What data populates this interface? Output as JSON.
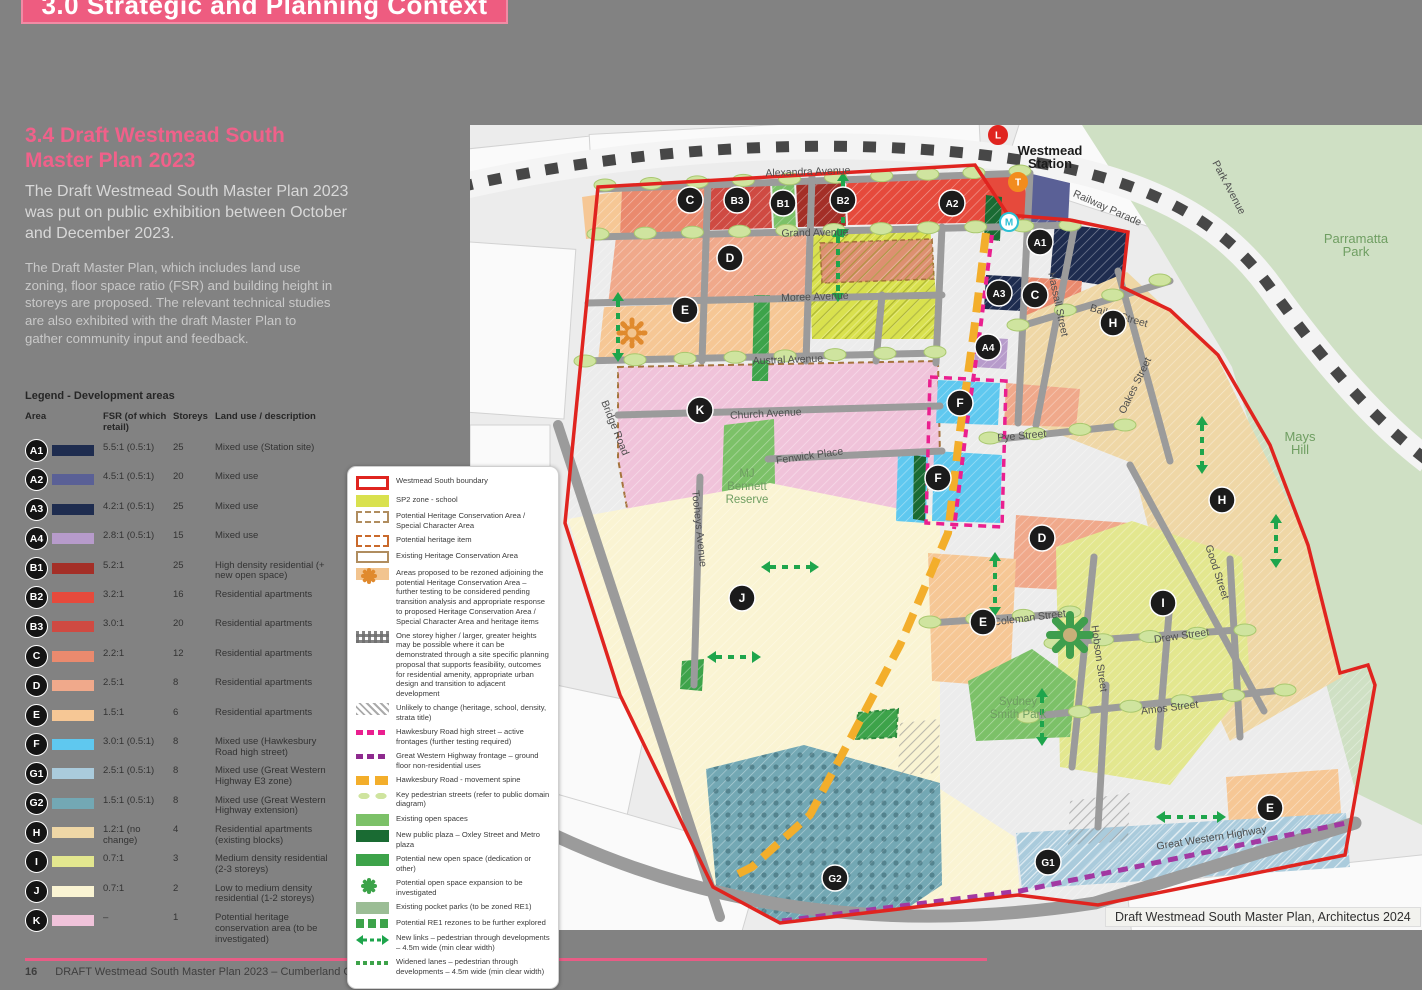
{
  "page": {
    "banner_title": "3.0 Strategic and Planning Context",
    "section_heading": "3.4 Draft Westmead South Master Plan 2023",
    "para1": "The Draft Westmead South Master Plan 2023 was put on public exhibition between October and December 2023.",
    "para2": "The Draft Master Plan, which includes land use zoning, floor space ratio (FSR) and building height in storeys are proposed. The relevant technical studies are also exhibited with the draft Master Plan to gather community input and feedback.",
    "footer_page": "16",
    "footer_text": "DRAFT Westmead South Master Plan 2023 – Cumberland City Council"
  },
  "palette": {
    "A1": "#1e2c4f",
    "A2": "#5a6096",
    "A3": "#1e2c4f",
    "A4": "#b79bcb",
    "B1": "#a42f27",
    "B2": "#e64a3c",
    "B3": "#cf4a42",
    "C": "#ea8a6e",
    "D": "#f0a98b",
    "Ddark": "#dd9070",
    "E": "#f6c795",
    "F": "#5fc8ef",
    "G1": "#aacbdc",
    "G2": "#73a8b4",
    "H": "#efd7a6",
    "I": "#e3e78f",
    "J": "#faf4d3",
    "K": "#f0c3da",
    "school": "#d9e14e",
    "open": "#7cc168",
    "newopen": "#3da34a",
    "plaza": "#1a6b33",
    "sage": "#9bbd95",
    "road": "#9b9b9b",
    "boundary": "#e0241f",
    "spine": "#f3ae2b",
    "magenta": "#ea1f8f",
    "purple": "#a238a2",
    "parkland": "#cfe0c4",
    "accent_pink": "#ee5c80"
  },
  "dev_legend": {
    "title": "Legend - Development areas",
    "columns": {
      "area": "Area",
      "fsr": "FSR (of which retail)",
      "storeys": "Storeys",
      "use": "Land use / description"
    },
    "rows": [
      {
        "area": "A1",
        "fsr": "5.5:1 (0.5:1)",
        "storeys": "25",
        "use": "Mixed use (Station site)"
      },
      {
        "area": "A2",
        "fsr": "4.5:1 (0.5:1)",
        "storeys": "20",
        "use": "Mixed use"
      },
      {
        "area": "A3",
        "fsr": "4.2:1 (0.5:1)",
        "storeys": "25",
        "use": "Mixed use"
      },
      {
        "area": "A4",
        "fsr": "2.8:1 (0.5:1)",
        "storeys": "15",
        "use": "Mixed use"
      },
      {
        "area": "B1",
        "fsr": "5.2:1",
        "storeys": "25",
        "use": "High density residential (+ new open space)"
      },
      {
        "area": "B2",
        "fsr": "3.2:1",
        "storeys": "16",
        "use": "Residential apartments"
      },
      {
        "area": "B3",
        "fsr": "3.0:1",
        "storeys": "20",
        "use": "Residential apartments"
      },
      {
        "area": "C",
        "fsr": "2.2:1",
        "storeys": "12",
        "use": "Residential apartments"
      },
      {
        "area": "D",
        "fsr": "2.5:1",
        "storeys": "8",
        "use": "Residential apartments"
      },
      {
        "area": "E",
        "fsr": "1.5:1",
        "storeys": "6",
        "use": "Residential apartments"
      },
      {
        "area": "F",
        "fsr": "3.0:1 (0.5:1)",
        "storeys": "8",
        "use": "Mixed use (Hawkesbury Road high street)"
      },
      {
        "area": "G1",
        "fsr": "2.5:1 (0.5:1)",
        "storeys": "8",
        "use": "Mixed use (Great Western Highway E3 zone)"
      },
      {
        "area": "G2",
        "fsr": "1.5:1 (0.5:1)",
        "storeys": "8",
        "use": "Mixed use (Great Western Highway extension)"
      },
      {
        "area": "H",
        "fsr": "1.2:1 (no change)",
        "storeys": "4",
        "use": "Residential apartments (existing blocks)"
      },
      {
        "area": "I",
        "fsr": "0.7:1",
        "storeys": "3",
        "use": "Medium density residential (2-3 storeys)"
      },
      {
        "area": "J",
        "fsr": "0.7:1",
        "storeys": "2",
        "use": "Low to medium density residential (1-2 storeys)"
      },
      {
        "area": "K",
        "fsr": "–",
        "storeys": "1",
        "use": "Potential heritage conservation area (to be investigated)"
      }
    ]
  },
  "map_legend": {
    "items": [
      {
        "sw": "boundary",
        "label": "Westmead South boundary"
      },
      {
        "sw": "school",
        "label": "SP2 zone - school"
      },
      {
        "sw": "hca",
        "label": "Potential Heritage Conservation Area / Special Character Area"
      },
      {
        "sw": "heritage-item",
        "label": "Potential heritage item"
      },
      {
        "sw": "ehca",
        "label": "Existing Heritage Conservation Area"
      },
      {
        "sw": "tanflower",
        "label": "Areas proposed to be rezoned adjoining the potential Heritage Conservation Area – further testing to be considered pending transition analysis and appropriate response to proposed Heritage Conservation Area / Special Character Area and heritage items"
      },
      {
        "sw": "check",
        "label": "One storey higher / larger, greater heights may be possible where it can be demonstrated through a site specific planning proposal that supports feasibility, outcomes for residential amenity, appropriate urban design and transition to adjacent development"
      },
      {
        "sw": "grayhatch",
        "label": "Unlikely to change (heritage, school, density, strata title)"
      },
      {
        "sw": "magenta",
        "label": "Hawkesbury Road high street – active frontages (further testing required)"
      },
      {
        "sw": "purple",
        "label": "Great Western Highway frontage – ground floor non-residential uses"
      },
      {
        "sw": "gold",
        "label": "Hawkesbury Road - movement spine"
      },
      {
        "sw": "ovals",
        "label": "Key pedestrian streets (refer to public domain diagram)"
      },
      {
        "sw": "open",
        "label": "Existing open spaces"
      },
      {
        "sw": "plaza",
        "label": "New public plaza – Oxley Street and Metro plaza"
      },
      {
        "sw": "newopen",
        "label": "Potential new open space (dedication or other)"
      },
      {
        "sw": "flower",
        "label": "Potential open space expansion to be investigated"
      },
      {
        "sw": "sage",
        "label": "Existing pocket parks (to be zoned RE1)"
      },
      {
        "sw": "re1",
        "label": "Potential RE1 rezones to be further explored"
      },
      {
        "sw": "links",
        "label": "New links – pedestrian through developments – 4.5m wide (min clear width)"
      },
      {
        "sw": "widened",
        "label": "Widened lanes – pedestrian through developments – 4.5m wide (min clear width)"
      }
    ]
  },
  "map": {
    "attribution": "Draft Westmead South Master Plan, Architectus 2024",
    "labels": [
      {
        "t": "Alexandra Avenue",
        "x": 338,
        "y": 50,
        "r": -2,
        "cls": "street"
      },
      {
        "t": "Grand Avenue",
        "x": 345,
        "y": 111,
        "r": -1,
        "cls": "street"
      },
      {
        "t": "Moree Avenue",
        "x": 345,
        "y": 175,
        "r": -2,
        "cls": "street"
      },
      {
        "t": "Austral Avenue",
        "x": 318,
        "y": 238,
        "r": -2,
        "cls": "street"
      },
      {
        "t": "Church Avenue",
        "x": 296,
        "y": 292,
        "r": -3,
        "cls": "street"
      },
      {
        "t": "Fenwick Place",
        "x": 340,
        "y": 334,
        "r": -8,
        "cls": "street"
      },
      {
        "t": "Railway Parade",
        "x": 636,
        "y": 86,
        "r": 24,
        "cls": "street"
      },
      {
        "t": "Park Avenue",
        "x": 756,
        "y": 64,
        "r": 62,
        "cls": "street"
      },
      {
        "t": "Hassall Street",
        "x": 585,
        "y": 180,
        "r": 78,
        "cls": "street"
      },
      {
        "t": "Bailey Street",
        "x": 648,
        "y": 194,
        "r": 16,
        "cls": "street"
      },
      {
        "t": "Pye Street",
        "x": 552,
        "y": 314,
        "r": -5,
        "cls": "street"
      },
      {
        "t": "Oakes Street",
        "x": 668,
        "y": 262,
        "r": -64,
        "cls": "street"
      },
      {
        "t": "Good Street",
        "x": 744,
        "y": 448,
        "r": 72,
        "cls": "street"
      },
      {
        "t": "Coleman Street",
        "x": 560,
        "y": 496,
        "r": -7,
        "cls": "street"
      },
      {
        "t": "Drew Street",
        "x": 712,
        "y": 514,
        "r": -8,
        "cls": "street"
      },
      {
        "t": "Hobson Street",
        "x": 626,
        "y": 534,
        "r": 82,
        "cls": "street"
      },
      {
        "t": "Amos Street",
        "x": 700,
        "y": 586,
        "r": -7,
        "cls": "street"
      },
      {
        "t": "Great Western Highway",
        "x": 742,
        "y": 716,
        "r": -9,
        "cls": "street"
      },
      {
        "t": "Bridge Road",
        "x": 142,
        "y": 304,
        "r": 68,
        "cls": "street"
      },
      {
        "t": "Tooheys Avenue",
        "x": 226,
        "y": 404,
        "r": 84,
        "cls": "street"
      },
      {
        "lines": [
          "MJ",
          "Bennett",
          "Reserve"
        ],
        "x": 277,
        "y": 352,
        "cls": "park"
      },
      {
        "lines": [
          "Sydney",
          "Smith Park"
        ],
        "x": 548,
        "y": 580,
        "cls": "park"
      },
      {
        "lines": [
          "Mays",
          "Hill"
        ],
        "x": 830,
        "y": 316,
        "cls": "bigpark"
      },
      {
        "lines": [
          "Parramatta",
          "Park"
        ],
        "x": 886,
        "y": 118,
        "cls": "bigpark"
      },
      {
        "lines": [
          "Westmead",
          "Station"
        ],
        "x": 580,
        "y": 30,
        "cls": "station"
      }
    ],
    "markers": [
      {
        "t": "C",
        "x": 220,
        "y": 75
      },
      {
        "t": "B3",
        "x": 267,
        "y": 75
      },
      {
        "t": "B1",
        "x": 313,
        "y": 78
      },
      {
        "t": "B2",
        "x": 373,
        "y": 75
      },
      {
        "t": "A2",
        "x": 482,
        "y": 78
      },
      {
        "t": "A1",
        "x": 570,
        "y": 117
      },
      {
        "t": "A3",
        "x": 529,
        "y": 168
      },
      {
        "t": "C",
        "x": 565,
        "y": 170
      },
      {
        "t": "H",
        "x": 643,
        "y": 198
      },
      {
        "t": "A4",
        "x": 518,
        "y": 222
      },
      {
        "t": "E",
        "x": 215,
        "y": 185
      },
      {
        "t": "D",
        "x": 260,
        "y": 133
      },
      {
        "t": "F",
        "x": 490,
        "y": 278
      },
      {
        "t": "K",
        "x": 230,
        "y": 285
      },
      {
        "t": "F",
        "x": 468,
        "y": 353
      },
      {
        "t": "D",
        "x": 572,
        "y": 413
      },
      {
        "t": "H",
        "x": 752,
        "y": 375
      },
      {
        "t": "I",
        "x": 693,
        "y": 478
      },
      {
        "t": "J",
        "x": 272,
        "y": 473
      },
      {
        "t": "E",
        "x": 513,
        "y": 497
      },
      {
        "t": "E",
        "x": 800,
        "y": 683
      },
      {
        "t": "G2",
        "x": 365,
        "y": 753
      },
      {
        "t": "G1",
        "x": 578,
        "y": 737
      }
    ],
    "transit": [
      {
        "t": "L",
        "x": 528,
        "y": 10,
        "c": "#e0241f",
        "fg": "#fff"
      },
      {
        "t": "T",
        "x": 548,
        "y": 57,
        "c": "#f28c1e",
        "fg": "#fff"
      },
      {
        "t": "M",
        "x": 539,
        "y": 97,
        "c": "#ffffff",
        "fg": "#2bbfd4",
        "ring": "#2bbfd4"
      }
    ],
    "oval_rows": [
      {
        "x1": 135,
        "y1": 60,
        "x2": 550,
        "y2": 46,
        "n": 10
      },
      {
        "x1": 128,
        "y1": 109,
        "x2": 600,
        "y2": 100,
        "n": 11
      },
      {
        "x1": 115,
        "y1": 236,
        "x2": 465,
        "y2": 227,
        "n": 8
      },
      {
        "x1": 520,
        "y1": 313,
        "x2": 655,
        "y2": 300,
        "n": 4
      },
      {
        "x1": 460,
        "y1": 497,
        "x2": 600,
        "y2": 487,
        "n": 4
      },
      {
        "x1": 585,
        "y1": 518,
        "x2": 775,
        "y2": 505,
        "n": 5
      },
      {
        "x1": 558,
        "y1": 592,
        "x2": 815,
        "y2": 565,
        "n": 6
      },
      {
        "x1": 548,
        "y1": 200,
        "x2": 690,
        "y2": 155,
        "n": 4
      }
    ],
    "links": [
      {
        "x": 373,
        "y": 56,
        "l": 48,
        "o": "v"
      },
      {
        "x": 148,
        "y": 176,
        "l": 52,
        "o": "v"
      },
      {
        "x": 368,
        "y": 112,
        "l": 56,
        "o": "v"
      },
      {
        "x": 525,
        "y": 436,
        "l": 46,
        "o": "v"
      },
      {
        "x": 572,
        "y": 572,
        "l": 40,
        "o": "v"
      },
      {
        "x": 806,
        "y": 398,
        "l": 36,
        "o": "v"
      },
      {
        "x": 732,
        "y": 300,
        "l": 40,
        "o": "v"
      },
      {
        "x": 695,
        "y": 692,
        "l": 52,
        "o": "h"
      },
      {
        "x": 300,
        "y": 442,
        "l": 40,
        "o": "h"
      },
      {
        "x": 246,
        "y": 532,
        "l": 36,
        "o": "h"
      }
    ],
    "flowers": [
      {
        "x": 162,
        "y": 208,
        "c": "#e08a2e",
        "dashed": true,
        "r": 13
      },
      {
        "x": 600,
        "y": 510,
        "c": "#3f9e4d",
        "r": 20
      }
    ]
  }
}
